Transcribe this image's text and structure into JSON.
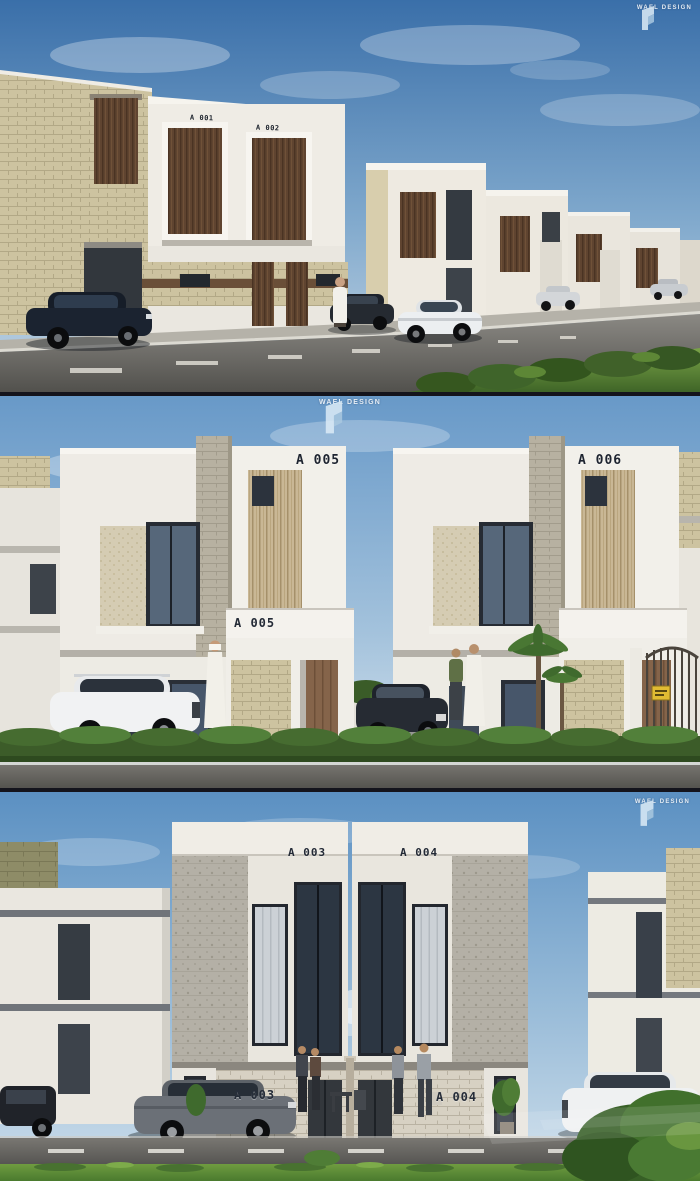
{
  "scene": {
    "description": "Exterior 3D renders of a modern villa compound, three stacked views",
    "views": [
      "Street perspective of villa row",
      "Front elevation of units A 005 and A 006",
      "Front elevation of units A 003 and A 004"
    ]
  },
  "brand": {
    "logo_text": "WAEL DESIGN"
  },
  "panels": {
    "top": {
      "labels": {
        "parapet_left": "A 001",
        "parapet_right": "A 002"
      }
    },
    "middle": {
      "labels": {
        "left_tower": "A 005",
        "right_tower": "A 006",
        "entrance_plaque": "A 005"
      }
    },
    "bottom": {
      "labels": {
        "left_tower": "A 003",
        "right_tower": "A 004",
        "entrance_left": "A 003",
        "entrance_right": "A 004"
      }
    }
  },
  "colors": {
    "sky": "#5b90c2",
    "facade_white": "#ece9e2",
    "stone_beige": "#cdc3a0",
    "wood_brown": "#5f4430",
    "louver_tan": "#c9b795",
    "road_grey": "#55544f",
    "grass_green": "#4a7a2e",
    "label_dark": "#1e2430",
    "sign_yellow": "#e0bb33"
  }
}
